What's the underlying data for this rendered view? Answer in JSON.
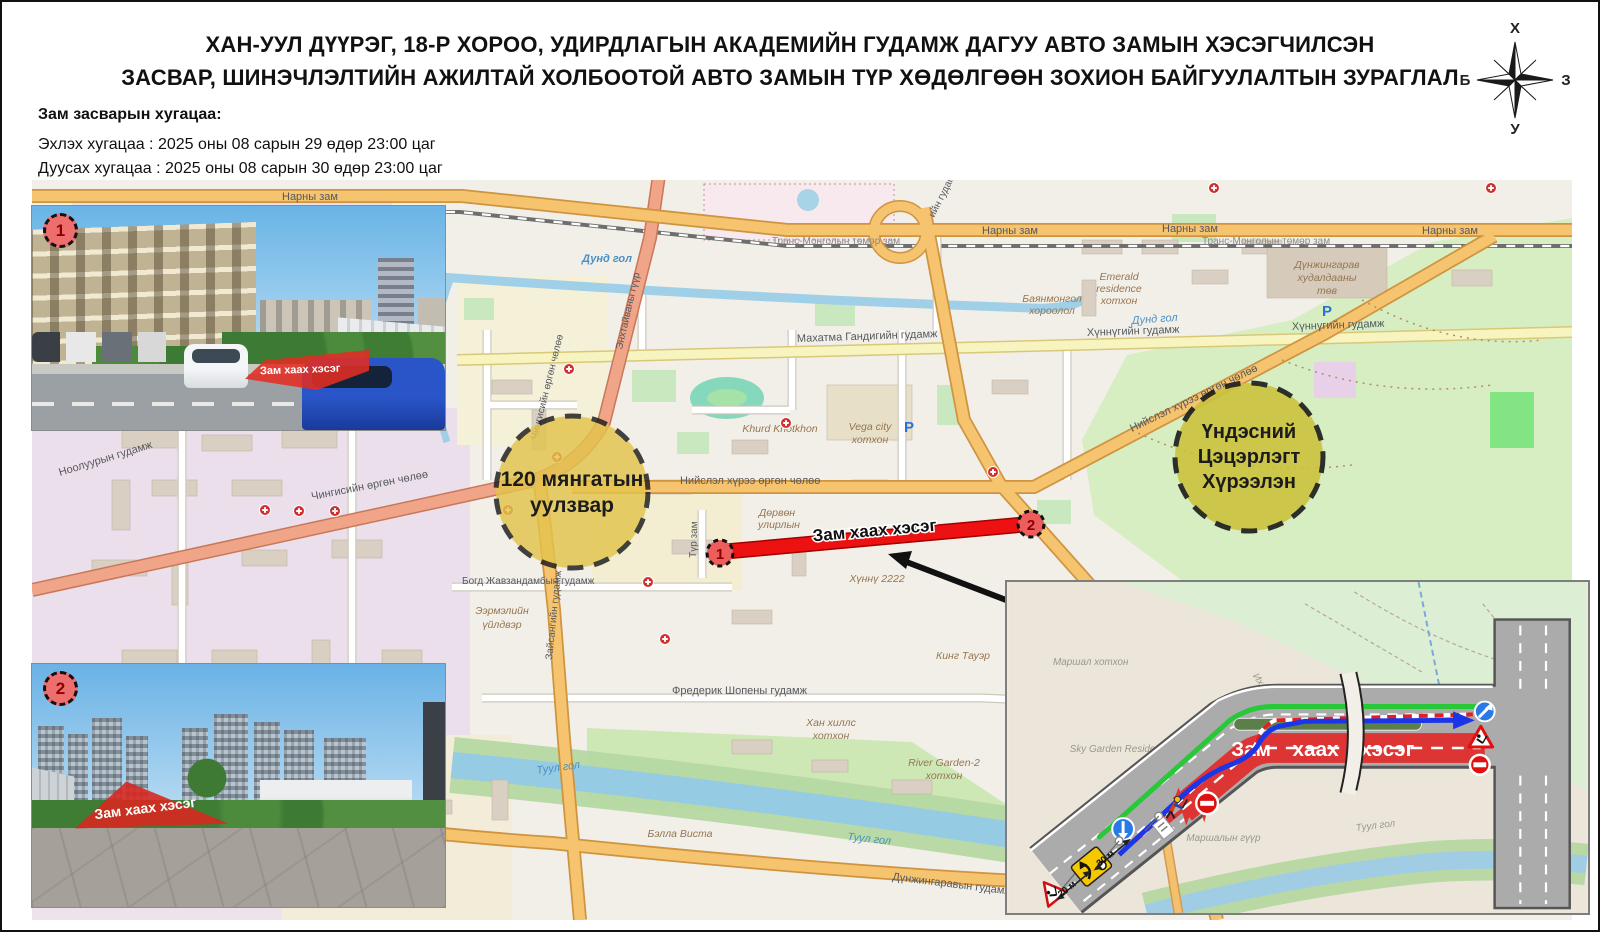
{
  "title": {
    "line1": "ХАН-УУЛ ДҮҮРЭГ, 18-Р ХОРОО, УДИРДЛАГЫН АКАДЕМИЙН ГУДАМЖ ДАГУУ АВТО ЗАМЫН ХЭСЭГЧИЛСЭН",
    "line2": "ЗАСВАР,  ШИНЭЧЛЭЛТИЙН АЖИЛТАЙ ХОЛБООТОЙ АВТО ЗАМЫН ТҮР ХӨДӨЛГӨӨН ЗОХИОН БАЙГУУЛАЛТЫН ЗУРАГЛАЛ"
  },
  "schedule": {
    "heading": "Зам засварын хугацаа:",
    "start_line": "Эхлэх хугацаа : 2025 оны 08 сарын 29 өдөр 23:00 цаг",
    "end_line": "Дуусах хугацаа : 2025 оны 08 сарын 30 өдөр 23:00 цаг"
  },
  "compass": {
    "north": "Х",
    "south": "У",
    "west": "Б",
    "east": "З"
  },
  "closure": {
    "label": "Зам хаах хэсэг",
    "marker1": "1",
    "marker2": "2"
  },
  "junction_circle": {
    "line1": "120 мянгатын",
    "line2": "уулзвар"
  },
  "park_circle": {
    "line1": "Үндэсний",
    "line2": "Цэцэрлэгт",
    "line3": "Хүрээлэн"
  },
  "streets": {
    "narny_zam": "Нарны зам",
    "trans_mongol": "Транс-Монголын төмөр зам",
    "dund_gol": "Дунд гол",
    "mahatma": "Махатма Гандигийн гудамж",
    "khunnu_st": "Хүннүгийн гудамж",
    "niislel": "Нийслэл хүрээ өргөн чөлөө",
    "chinggis": "Чингисийн өргөн чөлөө",
    "nooluur": "Ноолуурын гудамж",
    "bogd": "Богд Жавзандамбын гудамж",
    "zaisan_st": "Зайсангийн гудамж",
    "tur_zam": "Түр зам",
    "chopin": "Фредерик Шопены гудамж",
    "dunjingarav_st": "Дүнжингаравын гудамж",
    "enkhtaivan": "Энхтайваны гүүр",
    "loop_st": "ийн гудамж",
    "khunnu2222": "Хүннү 2222",
    "king_tower": "Кинг Тауэр",
    "khurd": "Khurd Khotkhon",
    "bella_vista": "Бэлла Виста",
    "tuul_gol": "Туул гол",
    "parking": "P",
    "mall": {
      "l1": "Дүнжингарав",
      "l2": "худалдааны",
      "l3": "төв"
    },
    "emerald": {
      "l1": "Emerald",
      "l2": "residence",
      "l3": "хотхон"
    },
    "bayanmongol": {
      "l1": "Баянмонгол",
      "l2": "хороолол"
    },
    "vega": {
      "l1": "Vega city",
      "l2": "хотхон"
    },
    "eermel": {
      "l1": "Ээрмэлийн",
      "l2": "үйлдвэр"
    },
    "dorvon": {
      "l1": "Дөрвөн",
      "l2": "улирлын"
    },
    "khan_hills": {
      "l1": "Хан хиллс",
      "l2": "хотхон"
    },
    "river_garden": {
      "l1": "River Garden-2",
      "l2": "хотхон"
    }
  },
  "photos": {
    "photo1_badge": "1",
    "photo2_badge": "2",
    "overlay_label": "Зам хаах хэсэг"
  },
  "detail": {
    "closure_label": "Зам хаах хэсэг",
    "dist_20": "20 м",
    "dist_30": "30 м",
    "marshal_khotkhon": "Маршал хотхон",
    "sky_garden": "Sky Garden Residence",
    "ikh_mongol": "Их Монгол улсын гүүр",
    "marshal_bridge": "Маршалын гүүр",
    "tuul_gol": "Туул гол"
  },
  "colors": {
    "closure_red": "#e60f0f",
    "detour_green": "#28c838",
    "detour_blue": "#1b35e8",
    "junction_yellow": "#e3c44c",
    "park_olive": "#cbc23e"
  }
}
